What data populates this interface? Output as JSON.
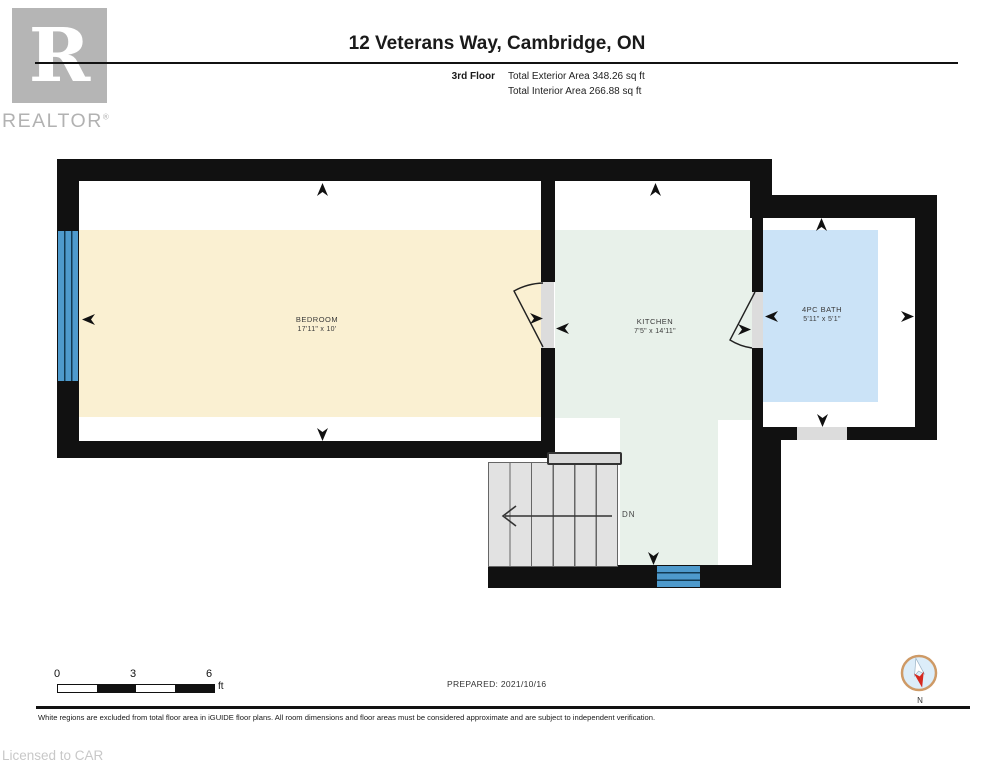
{
  "header": {
    "brand": {
      "logo_letter": "R",
      "brand_name": "REALTOR",
      "registered_mark": "®"
    },
    "title": "12 Veterans Way, Cambridge, ON",
    "floor_label": "3rd Floor",
    "exterior_area": "Total Exterior Area 348.26 sq ft",
    "interior_area": "Total Interior Area 266.88 sq ft"
  },
  "floorplan": {
    "rooms": [
      {
        "name": "BEDROOM",
        "dimensions": "17'11\" x 10'"
      },
      {
        "name": "KITCHEN",
        "dimensions": "7'5\" x 14'11\""
      },
      {
        "name": "4PC BATH",
        "dimensions": "5'11\" x 5'1\""
      }
    ],
    "stairs": {
      "label": "DN"
    }
  },
  "footer": {
    "scale_bar": {
      "tick_labels": [
        "0",
        "3",
        "6"
      ],
      "unit": "ft"
    },
    "prepared": "PREPARED: 2021/10/16",
    "compass_label": "N",
    "disclaimer": "White regions are excluded from total floor area in iGUIDE floor plans. All room dimensions and floor areas must be considered approximate and are subject to independent verification.",
    "license": "Licensed to CAR"
  },
  "colors": {
    "wall": "#111111",
    "bedroom_floor": "#FAF0D2",
    "kitchen_floor": "#E8F1EA",
    "bath_floor": "#CBE3F7",
    "window_blue": "#4E9ACC",
    "door_panel": "#DCDCDC",
    "compass_ring": "#CE9A66",
    "compass_fill": "#DCEDF9",
    "compass_red": "#D6281E"
  }
}
